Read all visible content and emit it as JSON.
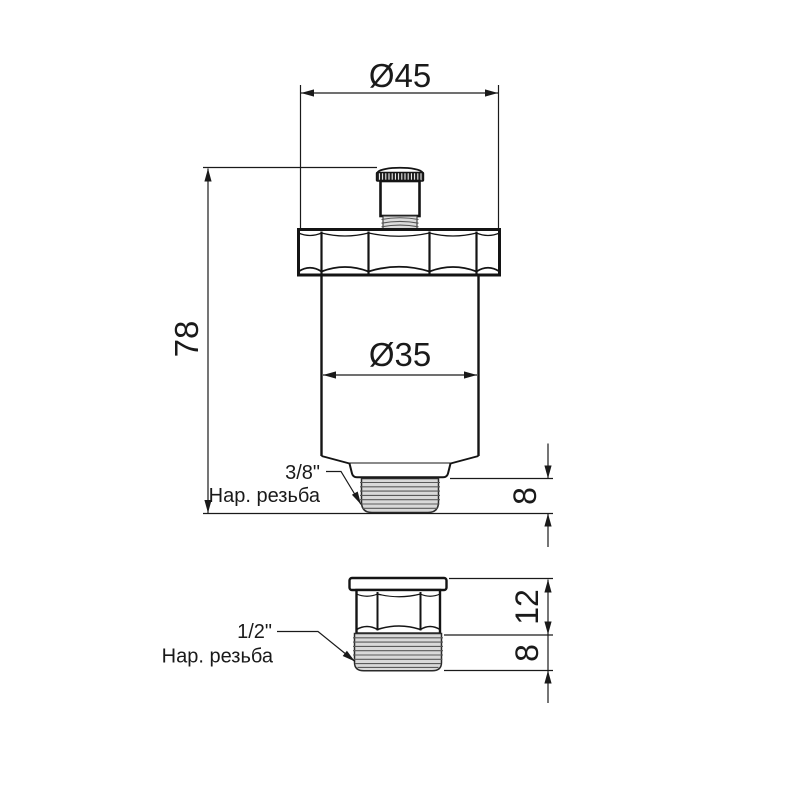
{
  "drawing": {
    "kind": "technical drawing, two orthographic views of an automatic air vent valve",
    "colors": {
      "background": "#ffffff",
      "line": "#1a1a1a",
      "thread_fill": "#d9d9d9",
      "thread_ridge": "#5a5a5a",
      "knurl_fill": "#1e1e1e"
    },
    "main_view": {
      "dim_diameter_top": "Ø45",
      "dim_height": "78",
      "dim_diameter_body": "Ø35",
      "dim_thread_length": "8",
      "thread_label": {
        "size": "3/8\"",
        "type": "Нар. резьба"
      }
    },
    "adapter_view": {
      "dim_hex_height": "12",
      "dim_thread_length": "8",
      "thread_label": {
        "size": "1/2\"",
        "type": "Нар. резьба"
      }
    }
  }
}
